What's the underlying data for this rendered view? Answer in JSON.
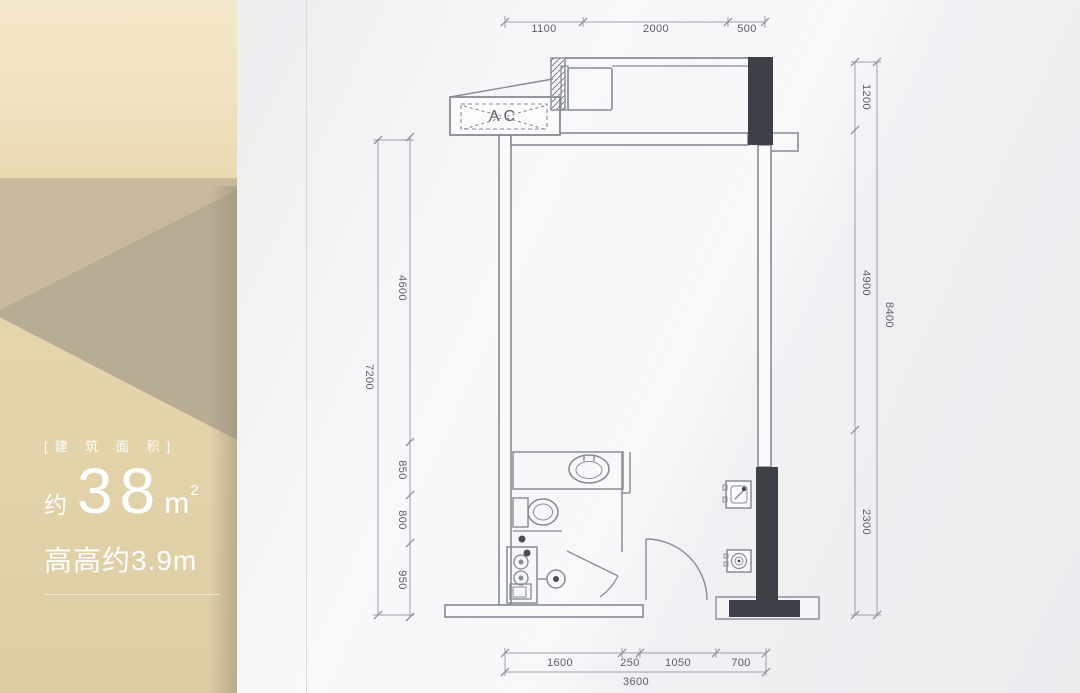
{
  "panel": {
    "area_title": "[建 筑 面 积]",
    "approx": "约",
    "area_value": "38",
    "area_unit": "m",
    "area_sup": "2",
    "height_line": "高高约3.9m"
  },
  "plan": {
    "ac": "AC",
    "dims": {
      "top": [
        "1100",
        "2000",
        "500"
      ],
      "left": [
        "4600",
        "850",
        "800",
        "950"
      ],
      "left_total": "7200",
      "right": [
        "1200",
        "4900",
        "2300"
      ],
      "right_total": "8400",
      "bottom": [
        "1600",
        "250",
        "1050",
        "700"
      ],
      "bottom_total": "3600"
    }
  },
  "colors": {
    "panel_gold": "#e9dab1",
    "panel_facet_dark": "#b8ad94",
    "wall_line": "#868c94",
    "structure_fill": "#3d4046",
    "dim_text": "#5a5f66"
  }
}
